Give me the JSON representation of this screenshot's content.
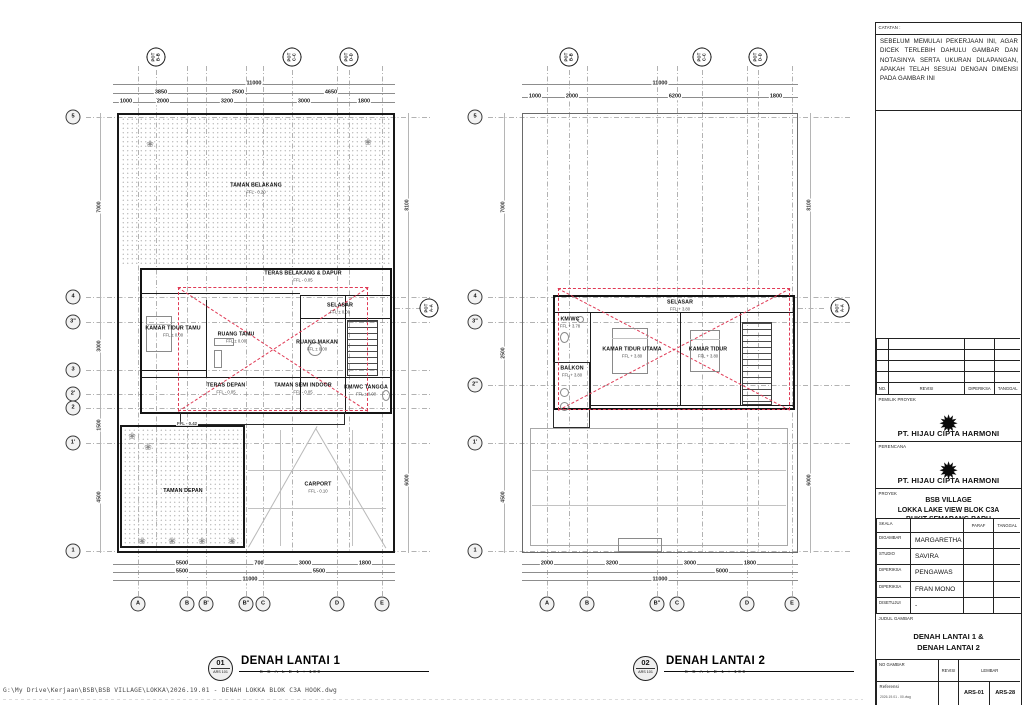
{
  "colors": {
    "red_dash": "#e03a55",
    "wall": "#1b1b1b",
    "grid": "#999999"
  },
  "icons": {
    "plant": "❀",
    "logo": "✹"
  },
  "notes": {
    "label": "CATATAN :",
    "text": "SEBELUM MEMULAI PEKERJAAN INI, AGAR DICEK TERLEBIH DAHULU GAMBAR DAN NOTASINYA SERTA UKURAN DILAPANGAN, APAKAH TELAH SESUAI DENGAN DIMENSI PADA GAMBAR INI"
  },
  "statusbar": {
    "path": "G:\\My Drive\\Kerjaan\\BSB\\BSB VILLAGE\\LOKKA\\2026.19.01 - DENAH LOKKA BLOK C3A HOOK.dwg"
  },
  "titleblock": {
    "rev_headers": {
      "no": "NO.",
      "revisi": "REVISI",
      "diperiksa": "DIPERIKSA",
      "tanggal": "TANGGAL"
    },
    "owner_label": "PEMILIK PROYEK",
    "owner_name": "PT. HIJAU CIPTA HARMONI",
    "planner_label": "PERENCANA",
    "planner_name": "PT. HIJAU CIPTA HARMONI",
    "project_label": "PROYEK",
    "project_line1": "BSB VILLAGE",
    "project_line2": "LOKKA LAKE VIEW BLOK C3A",
    "project_line3": "BUKIT SEMARANG BARU",
    "skala_label": "SKALA",
    "paraf_label": "PARAF",
    "tanggal_label": "TANGGAL",
    "approvals": [
      {
        "label": "DIGAMBAR",
        "value": "MARGARETHA"
      },
      {
        "label": "STUDIO",
        "value": "SAVIRA"
      },
      {
        "label": "DIPERIKSA",
        "value": "PENGAWAS"
      },
      {
        "label": "DIPERIKSA",
        "value": "FRAN MONO"
      },
      {
        "label": "DISETUJUI",
        "value": "-"
      }
    ],
    "judul_label": "JUDUL GAMBAR",
    "judul_line1": "DENAH LANTAI 1 &",
    "judul_line2": "DENAH LANTAI 2",
    "no_gambar_label": "NO GAMBAR",
    "revisi_label": "REVISI",
    "lembar_label": "LEMBAR",
    "referensi_label": "Referensi",
    "referensi_value": "2026.19.01 - 00.dwg",
    "sheet_no": "ARS-01",
    "sheet_count": "ARS-28"
  },
  "plan1": {
    "title": "DENAH LANTAI 1",
    "scale_text": "S C A L E   1 : 100",
    "detail_no": "01",
    "detail_code": "ARS 101",
    "pot_label": "POT",
    "sections_top": [
      "B-B",
      "C-C",
      "D-D"
    ],
    "section_side": "A-A",
    "cols": [
      "A",
      "B",
      "B'",
      "B\"",
      "C",
      "D",
      "E"
    ],
    "rows": [
      "5",
      "4",
      "3\"",
      "3",
      "2'",
      "2",
      "1'",
      "1"
    ],
    "dim_total": "11000",
    "dims_mid": [
      "3850",
      "2500",
      "4650"
    ],
    "dims_detail": [
      "1000",
      "2000",
      "3200",
      "3000",
      "1800"
    ],
    "dims_bottom_detail": [
      "5500",
      "700",
      "3000",
      "1800"
    ],
    "dims_bottom_mid": [
      "5500",
      "5500"
    ],
    "dim_bottom_total": "11000",
    "dims_left": [
      "7000",
      "3000",
      "1500",
      "4500"
    ],
    "dims_right": [
      "8100",
      "6000"
    ],
    "front_level": "FFL - 0.42",
    "rooms": [
      {
        "n": "TAMAN BELAKANG",
        "l": "FFL - 0.20"
      },
      {
        "n": "TERAS BELAKANG & DAPUR",
        "l": "FFL - 0.05"
      },
      {
        "n": "KAMAR TIDUR TAMU",
        "l": "FFL ± 0.00"
      },
      {
        "n": "RUANG TAMU",
        "l": "FFL ± 0.00"
      },
      {
        "n": "SELASAR",
        "l": "FFL ± 0.00"
      },
      {
        "n": "RUANG MAKAN",
        "l": "FFL ± 0.00"
      },
      {
        "n": "TERAS DEPAN",
        "l": "FFL - 0.05"
      },
      {
        "n": "TAMAN SEMI INDOOR",
        "l": "FFL - 0.05"
      },
      {
        "n": "KM/WC TANGGA",
        "l": "FFL ± 0.00"
      },
      {
        "n": "TAMAN DEPAN",
        "l": ""
      },
      {
        "n": "CARPORT",
        "l": "FFL - 0.10"
      }
    ]
  },
  "plan2": {
    "title": "DENAH LANTAI 2",
    "scale_text": "S C A L E   1 : 100",
    "detail_no": "02",
    "detail_code": "ARS 101",
    "pot_label": "POT",
    "sections_top": [
      "B-B",
      "C-C",
      "D-D"
    ],
    "section_side": "A-A",
    "cols": [
      "A",
      "B",
      "B\"",
      "C",
      "D",
      "E"
    ],
    "rows": [
      "5",
      "4",
      "3\"",
      "2\"",
      "1'",
      "1"
    ],
    "dim_total": "11000",
    "dims_detail": [
      "1000",
      "2000",
      "6200",
      "1800"
    ],
    "dims_bottom_detail": [
      "2000",
      "3200",
      "3000",
      "1800"
    ],
    "dims_bottom_mid": [
      "5000"
    ],
    "dim_bottom_total": "11000",
    "dims_left": [
      "7000",
      "2500",
      "4500"
    ],
    "dims_right": [
      "8100",
      "6000"
    ],
    "rooms": [
      {
        "n": "SELASAR",
        "l": "FFL + 3.80"
      },
      {
        "n": "KM/WC",
        "l": "FFL + 3.78"
      },
      {
        "n": "BALKON",
        "l": "FFL + 3.80"
      },
      {
        "n": "KAMAR TIDUR UTAMA",
        "l": "FFL + 3.80"
      },
      {
        "n": "KAMAR TIDUR",
        "l": "FFL + 3.80"
      }
    ]
  }
}
